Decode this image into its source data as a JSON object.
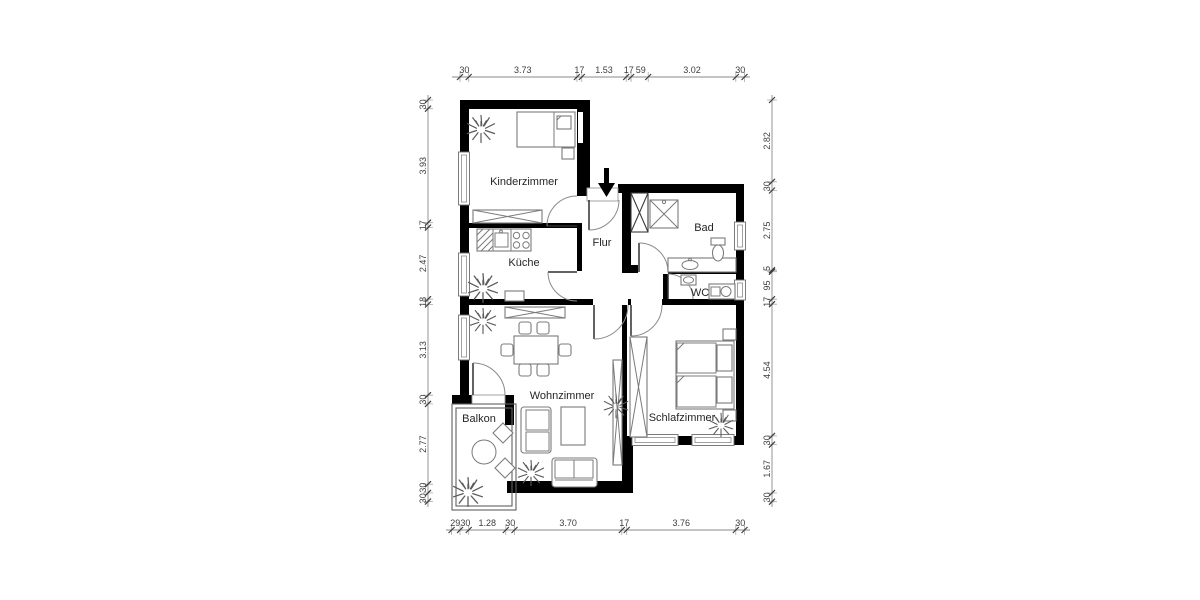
{
  "title": "Wohnung Grundriss",
  "rooms": {
    "kinderzimmer": "Kinderzimmer",
    "kueche": "Küche",
    "flur": "Flur",
    "bad": "Bad",
    "wc": "WC",
    "wohnzimmer": "Wohnzimmer",
    "schlafzimmer": "Schlafzimmer",
    "balkon": "Balkon"
  },
  "dimensions": {
    "top": [
      "30",
      "3.73",
      "17",
      "1.53",
      "17",
      "59",
      "3.02",
      "30"
    ],
    "bottom": [
      "29",
      "30",
      "1.28",
      "30",
      "3.70",
      "17",
      "3.76",
      "30"
    ],
    "left": [
      "30",
      "3.93",
      "17",
      "2.47",
      "18",
      "3.13",
      "30",
      "2.77",
      "30",
      "30"
    ],
    "right": [
      "2.82",
      "30",
      "2.75",
      "5",
      "95",
      "17",
      "4.54",
      "30",
      "1.67",
      "30"
    ]
  },
  "icons": {
    "entrance": "entrance-arrow-icon",
    "plant": "plant-icon",
    "door": "door-swing-symbol",
    "window": "window-symbol"
  },
  "colors": {
    "wall": "#000000",
    "furniture": "#7b7b7b",
    "dimension_text": "#3d3d3d",
    "background": "#ffffff"
  }
}
